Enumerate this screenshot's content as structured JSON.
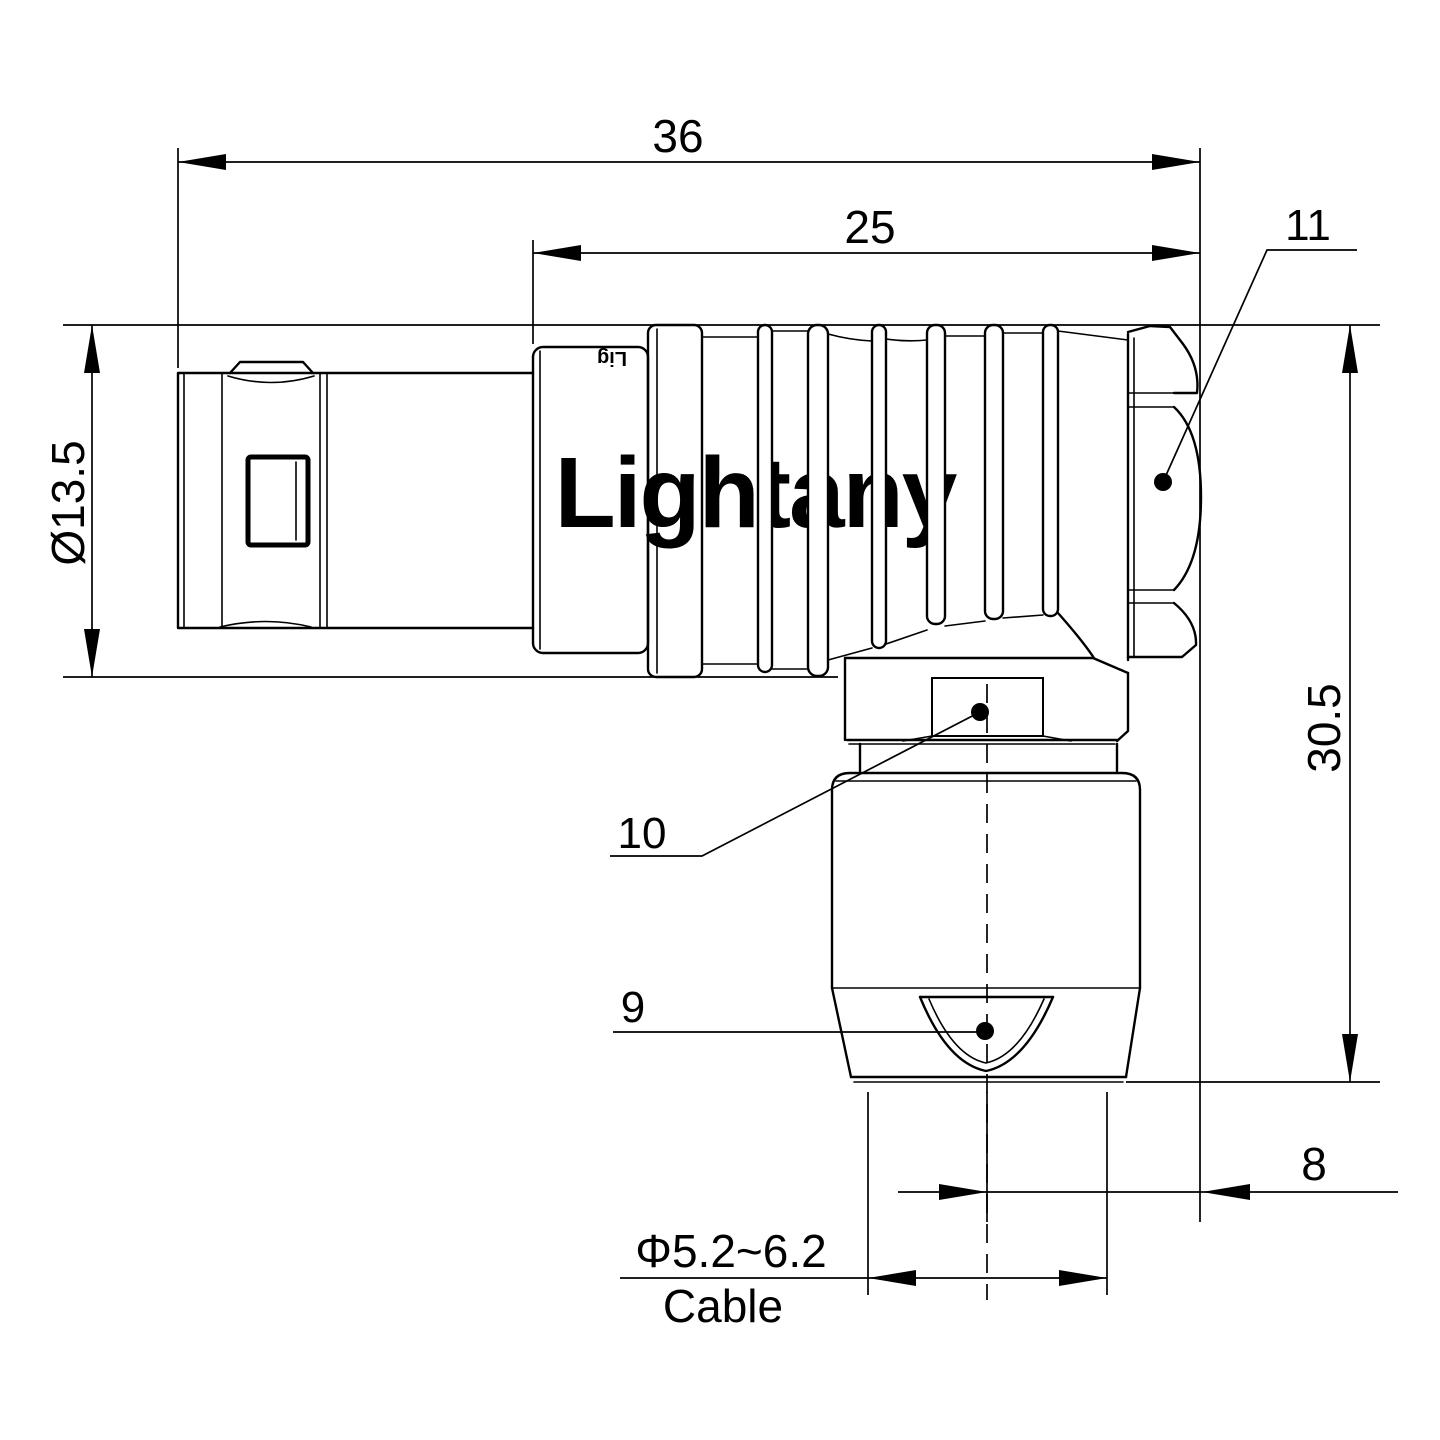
{
  "drawing": {
    "watermark": "Lightany",
    "engraving": "Lig",
    "colors": {
      "line": "#000000",
      "watermark": "#f8d2d3",
      "background": "#ffffff"
    },
    "dimensions": {
      "overall_length": "36",
      "rear_body_length": "25",
      "front_diameter": "Ø13.5",
      "overall_height": "30.5",
      "axis_to_face": "8",
      "cable_diameter": "Φ5.2~6.2",
      "cable_label": "Cable"
    },
    "callouts": {
      "back_nut": "11",
      "hex_flats": "10",
      "cable_clamp": "9"
    }
  }
}
